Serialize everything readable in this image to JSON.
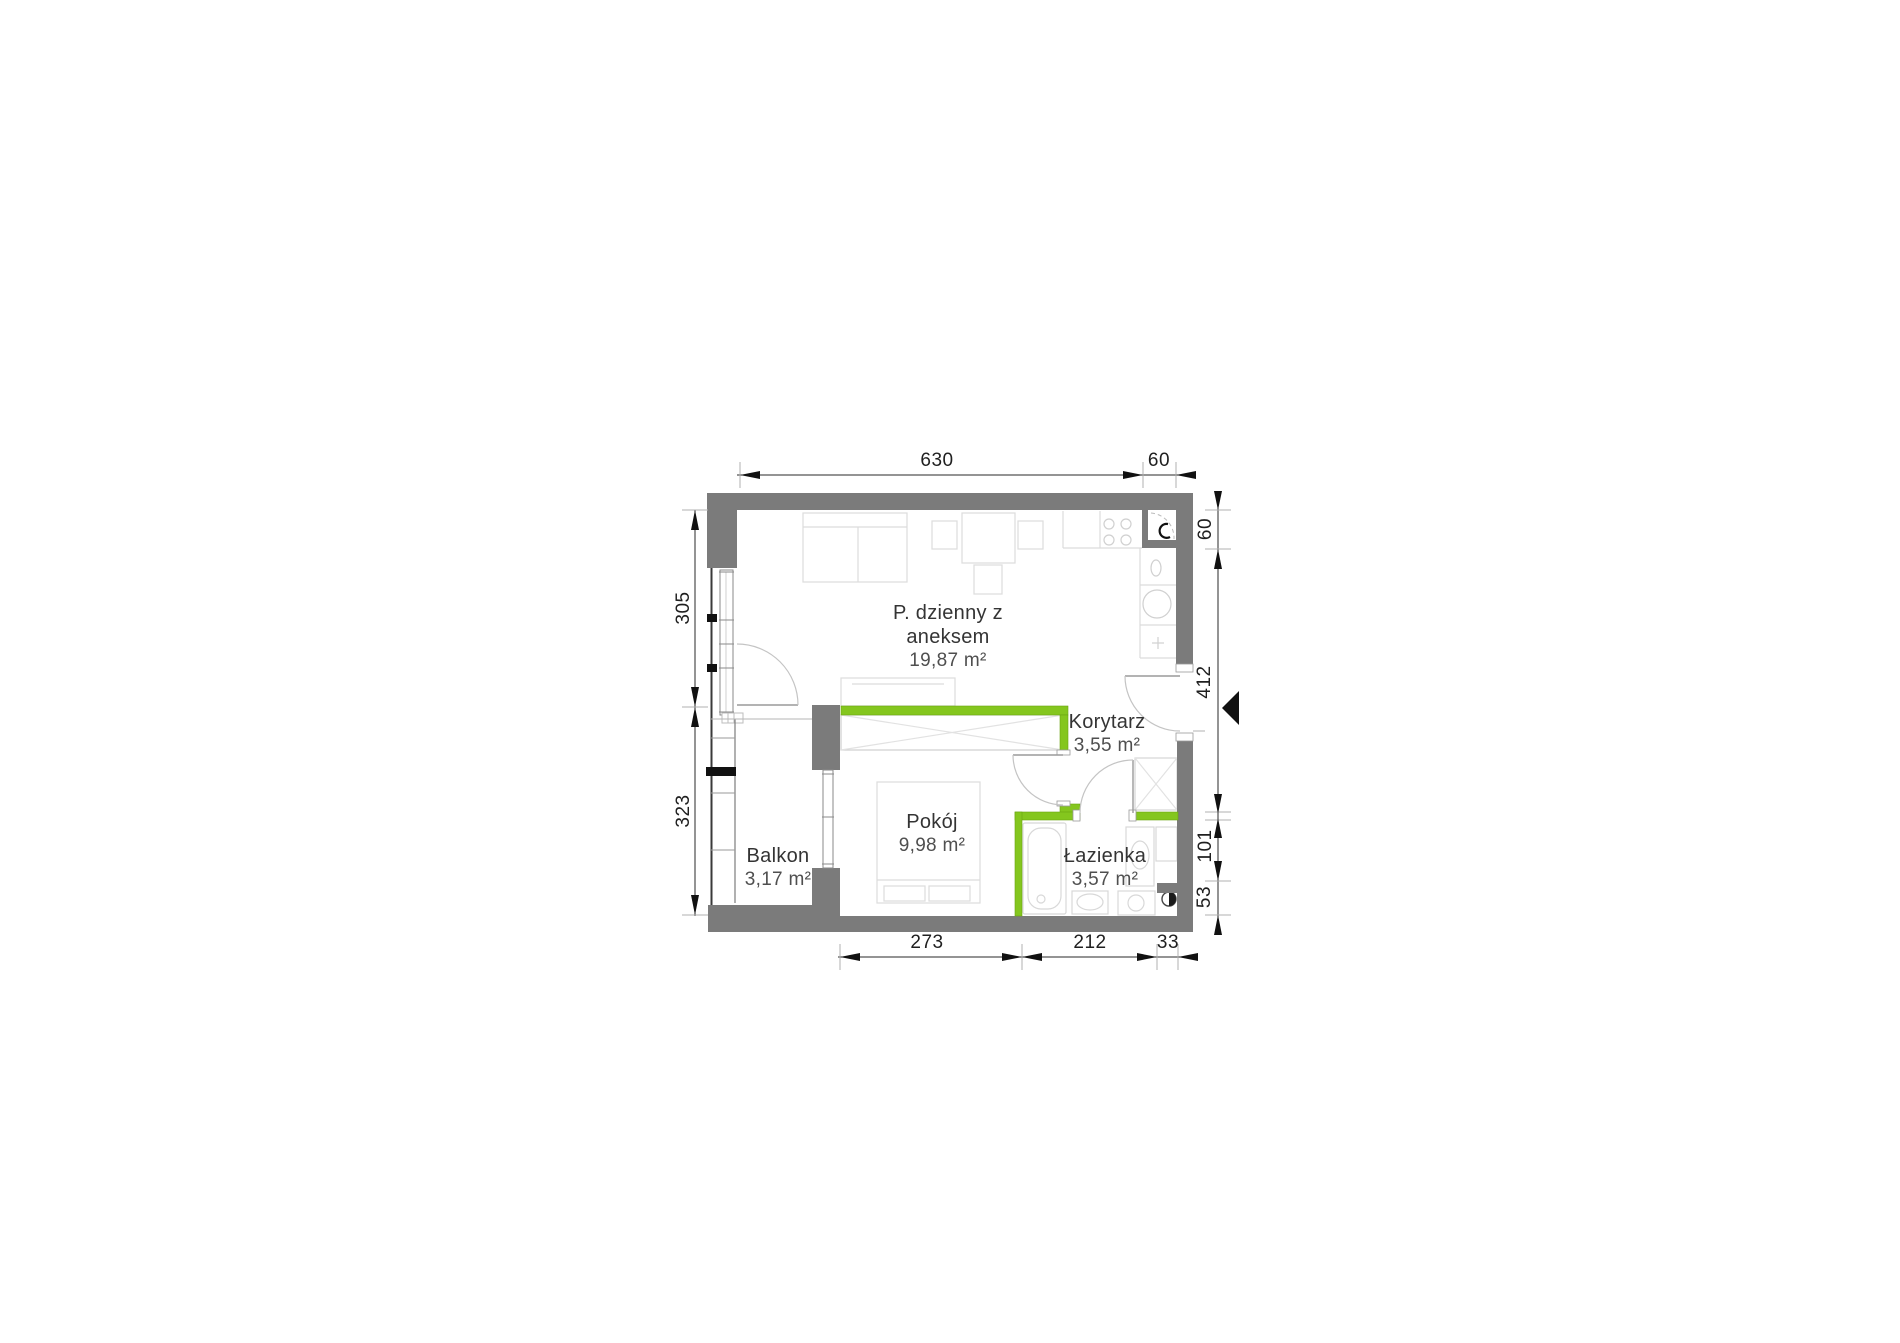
{
  "plan": {
    "type": "apartment-floor-plan",
    "rooms": [
      {
        "id": "living",
        "name": "P. dzienny z aneksem",
        "name_line1": "P. dzienny z",
        "name_line2": "aneksem",
        "area": "19,87 m²"
      },
      {
        "id": "korytarz",
        "name": "Korytarz",
        "area": "3,55 m²"
      },
      {
        "id": "pokoj",
        "name": "Pokój",
        "area": "9,98 m²"
      },
      {
        "id": "lazienka",
        "name": "Łazienka",
        "area": "3,57 m²"
      },
      {
        "id": "balkon",
        "name": "Balkon",
        "area": "3,17 m²"
      }
    ],
    "dimensions_cm": {
      "top": [
        "630",
        "60"
      ],
      "left": [
        "305",
        "323"
      ],
      "right": [
        "60",
        "412",
        "101",
        "53"
      ],
      "bottom": [
        "273",
        "212",
        "33"
      ]
    },
    "colors": {
      "wall_gray": "#7b7b7b",
      "highlight_wall_green": "#84c61e",
      "dimension_text": "#1f1f1f",
      "room_text": "#383838",
      "fixture_line": "#d9d9d9",
      "entrance_marker": "#111111"
    },
    "icons": [
      "entrance-triangle-icon"
    ]
  }
}
